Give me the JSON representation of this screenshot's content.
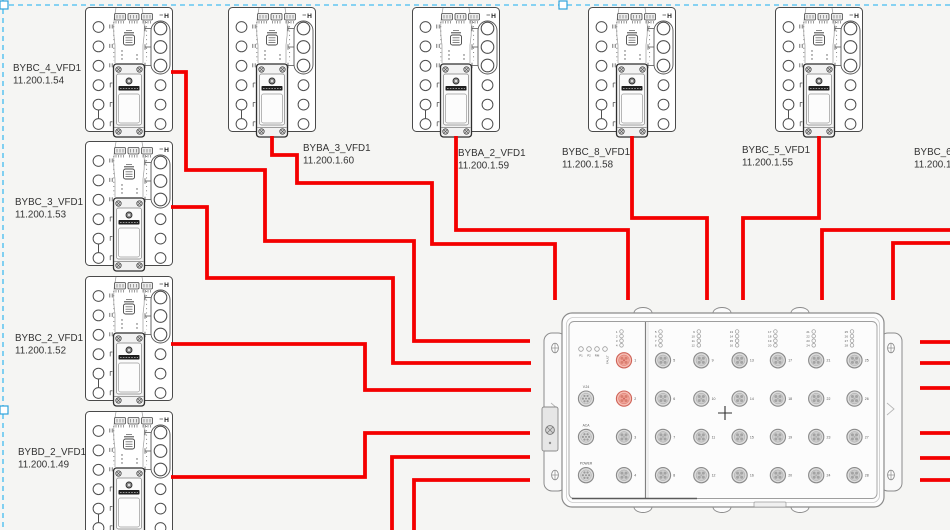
{
  "colors": {
    "cable": "#f40000",
    "selection": "#63c6f1",
    "selection_handle_border": "#2fa3dc",
    "device_stroke": "#4a4a4a",
    "text": "#333333",
    "tiny_text": "#555555",
    "box_stroke": "#8c8c8c",
    "port_fill": "#dcdcdc",
    "port_inner": "#cdcdcd",
    "port_stroke": "#8a8a8a",
    "port_contact": "#a3a3a3",
    "port_hl_fill": "#f6beb4",
    "port_hl_inner": "#f0a297",
    "port_hl_stroke": "#cf6459",
    "port_hl_contact": "#d97f70"
  },
  "device_corner_label": "H",
  "devices": [
    {
      "name": "BYBC_4_VFD1",
      "ip": "11.200.1.54",
      "x": 85,
      "y": 7,
      "label": {
        "x": 13,
        "y": 71
      }
    },
    {
      "name": "BYBC_3_VFD1",
      "ip": "11.200.1.53",
      "x": 85,
      "y": 141,
      "label": {
        "x": 15,
        "y": 205
      }
    },
    {
      "name": "BYBC_2_VFD1",
      "ip": "11.200.1.52",
      "x": 85,
      "y": 276,
      "label": {
        "x": 15,
        "y": 341
      }
    },
    {
      "name": "BYBD_2_VFD1",
      "ip": "11.200.1.49",
      "x": 85,
      "y": 411,
      "label": {
        "x": 18,
        "y": 455
      }
    },
    {
      "name": "BYBA_3_VFD1",
      "ip": "11.200.1.60",
      "x": 228,
      "y": 7,
      "label": {
        "x": 303,
        "y": 151
      }
    },
    {
      "name": "BYBA_2_VFD1",
      "ip": "11.200.1.59",
      "x": 412,
      "y": 7,
      "label": {
        "x": 458,
        "y": 156
      }
    },
    {
      "name": "BYBC_8_VFD1",
      "ip": "11.200.1.58",
      "x": 588,
      "y": 7,
      "label": {
        "x": 562,
        "y": 155
      }
    },
    {
      "name": "BYBC_5_VFD1",
      "ip": "11.200.1.55",
      "x": 775,
      "y": 7,
      "label": {
        "x": 742,
        "y": 153
      }
    },
    {
      "name": "BYBC_6_",
      "ip": "11.200.1.",
      "x": null,
      "y": null,
      "label": {
        "x": 914,
        "y": 155
      }
    }
  ],
  "switchbox": {
    "x": 562,
    "y": 313,
    "width": 322,
    "height": 194,
    "status_leds": [
      "P1",
      "P2",
      "RM",
      "FAULT"
    ],
    "side_ports": [
      {
        "label": "V.24",
        "row": 1
      },
      {
        "label": "ACA",
        "row": 2
      },
      {
        "label": "POWER",
        "row": 3
      }
    ],
    "port_columns": [
      [
        1,
        2,
        3,
        4
      ],
      [
        5,
        6,
        7,
        8
      ],
      [
        9,
        10,
        11,
        12
      ],
      [
        13,
        14,
        15,
        16
      ],
      [
        17,
        18,
        19,
        20
      ],
      [
        21,
        22,
        23,
        24
      ],
      [
        25,
        26,
        27,
        28
      ]
    ],
    "highlighted_ports": [
      1,
      2
    ]
  },
  "cables": [
    {
      "from": "BYBC_4_VFD1",
      "to": "switch-left",
      "points": [
        [
          171,
          72
        ],
        [
          186,
          72
        ],
        [
          186,
          170
        ],
        [
          265,
          170
        ],
        [
          265,
          241
        ],
        [
          414,
          241
        ],
        [
          414,
          341
        ],
        [
          530,
          341
        ]
      ]
    },
    {
      "from": "BYBC_3_VFD1",
      "to": "switch-left",
      "points": [
        [
          171,
          207
        ],
        [
          207,
          207
        ],
        [
          207,
          278
        ],
        [
          393,
          278
        ],
        [
          393,
          363
        ],
        [
          531,
          363
        ]
      ]
    },
    {
      "from": "BYBC_2_VFD1",
      "to": "switch-left",
      "points": [
        [
          171,
          344
        ],
        [
          365,
          344
        ],
        [
          365,
          390
        ],
        [
          531,
          390
        ]
      ]
    },
    {
      "from": "BYBD_2_VFD1",
      "to": "switch-left",
      "points": [
        [
          171,
          477
        ],
        [
          365,
          477
        ],
        [
          365,
          433
        ],
        [
          530,
          433
        ]
      ]
    },
    {
      "from": "off-screen-bottom",
      "to": "switch-left",
      "points": [
        [
          392,
          530
        ],
        [
          392,
          457
        ],
        [
          530,
          457
        ]
      ]
    },
    {
      "from": "off-screen-bottom",
      "to": "switch-left",
      "points": [
        [
          414,
          530
        ],
        [
          414,
          480
        ],
        [
          530,
          480
        ]
      ]
    },
    {
      "from": "BYBA_3_VFD1",
      "to": "switch-top",
      "points": [
        [
          272,
          136
        ],
        [
          272,
          155
        ],
        [
          297,
          155
        ],
        [
          297,
          183
        ],
        [
          432,
          183
        ],
        [
          432,
          244
        ],
        [
          555,
          244
        ],
        [
          555,
          300
        ]
      ]
    },
    {
      "from": "BYBA_2_VFD1",
      "to": "switch-top",
      "points": [
        [
          456,
          136
        ],
        [
          456,
          230
        ],
        [
          628,
          230
        ],
        [
          628,
          300
        ]
      ]
    },
    {
      "from": "BYBC_8_VFD1",
      "to": "switch-top",
      "points": [
        [
          632,
          136
        ],
        [
          632,
          218
        ],
        [
          707,
          218
        ],
        [
          707,
          300
        ]
      ]
    },
    {
      "from": "BYBC_5_VFD1",
      "to": "switch-top",
      "points": [
        [
          819,
          136
        ],
        [
          819,
          218
        ],
        [
          743,
          218
        ],
        [
          743,
          300
        ]
      ]
    },
    {
      "from": "off-screen-right",
      "to": "switch-top",
      "points": [
        [
          950,
          230
        ],
        [
          822,
          230
        ],
        [
          822,
          300
        ]
      ]
    },
    {
      "from": "off-screen-right",
      "to": "switch-top",
      "points": [
        [
          950,
          243
        ],
        [
          893,
          243
        ],
        [
          893,
          300
        ]
      ]
    },
    {
      "from": "switch-right",
      "to": "off-screen-right",
      "points": [
        [
          920,
          342
        ],
        [
          950,
          342
        ]
      ]
    },
    {
      "from": "switch-right",
      "to": "off-screen-right",
      "points": [
        [
          920,
          363
        ],
        [
          950,
          363
        ]
      ]
    },
    {
      "from": "switch-right",
      "to": "off-screen-right",
      "points": [
        [
          920,
          388
        ],
        [
          950,
          388
        ]
      ]
    },
    {
      "from": "switch-right",
      "to": "off-screen-right",
      "points": [
        [
          920,
          433
        ],
        [
          950,
          433
        ]
      ]
    },
    {
      "from": "switch-right",
      "to": "off-screen-right",
      "points": [
        [
          920,
          458
        ],
        [
          950,
          458
        ]
      ]
    },
    {
      "from": "switch-right",
      "to": "off-screen-right",
      "points": [
        [
          920,
          480
        ],
        [
          950,
          480
        ]
      ]
    }
  ],
  "selection": {
    "top_y": 5,
    "left_x": 3,
    "handle_size": 8,
    "handles": [
      {
        "x": 0,
        "y": 1
      },
      {
        "x": 559,
        "y": 1
      },
      {
        "x": 0,
        "y": 406
      }
    ]
  }
}
